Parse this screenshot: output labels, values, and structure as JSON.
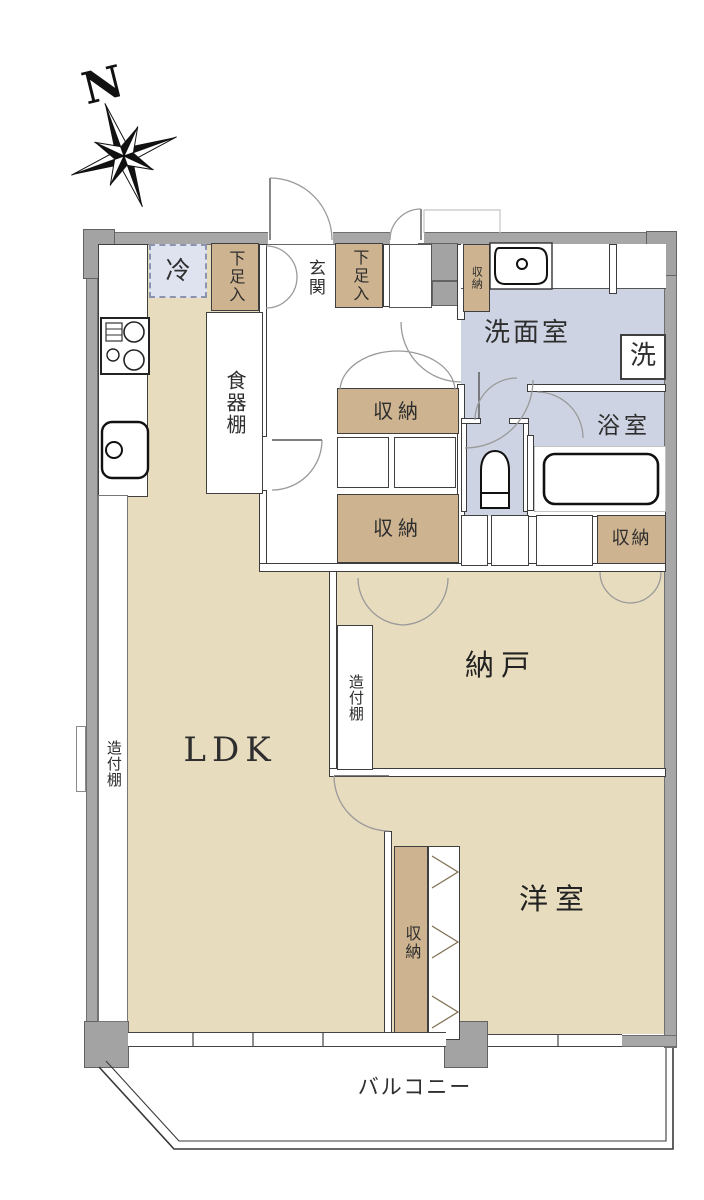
{
  "plan_title": "apartment-floor-plan",
  "compass": {
    "north_label": "N"
  },
  "rooms": {
    "ldk": {
      "label": "LDK"
    },
    "storage_room": {
      "label": "納戸"
    },
    "western_room": {
      "label": "洋室"
    },
    "washroom": {
      "label": "洗面室"
    },
    "bathroom": {
      "label": "浴室"
    },
    "entrance": {
      "label": "玄関"
    },
    "balcony": {
      "label": "バルコニー"
    }
  },
  "features": {
    "refrigerator": "冷",
    "shoe_cabinet": "下足入",
    "dish_shelf": "食器棚",
    "storage": "収納",
    "built_in_shelf": "造付棚",
    "washing_machine": "洗"
  },
  "colors": {
    "floor_wood": "#e8dcbe",
    "floor_wet": "#cdd3e2",
    "storage_fill": "#cdb38f",
    "refrigerator_fill": "#dfe3f0",
    "wall_gray": "#a7a7a7",
    "line_dark": "#3c3c3c"
  }
}
